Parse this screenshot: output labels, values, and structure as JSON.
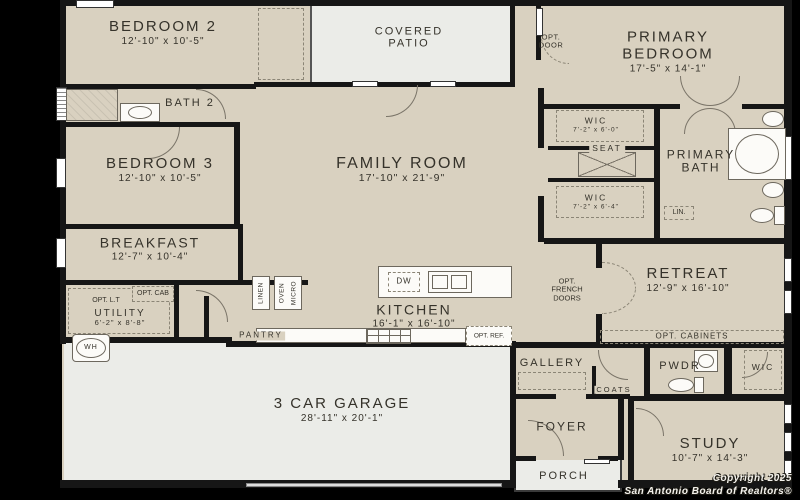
{
  "plan_title": "Single-story floor plan",
  "colors": {
    "background": "#000000",
    "room_fill": "#d9d1c0",
    "outdoor_fill": "#ebece8",
    "wall": "#161616",
    "text": "#35322a"
  },
  "rooms": {
    "bedroom2": {
      "name": "BEDROOM 2",
      "dims": "12'-10\" x 10'-5\""
    },
    "bath2": {
      "name": "BATH 2"
    },
    "bedroom3": {
      "name": "BEDROOM 3",
      "dims": "12'-10\" x 10'-5\""
    },
    "breakfast": {
      "name": "BREAKFAST",
      "dims": "12'-7\" x 10'-4\""
    },
    "utility": {
      "name": "UTILITY",
      "dims": "6'-2\" x 8'-8\""
    },
    "covered_patio": {
      "name": "COVERED PATIO"
    },
    "family_room": {
      "name": "FAMILY ROOM",
      "dims": "17'-10\" x 21'-9\""
    },
    "kitchen": {
      "name": "KITCHEN",
      "dims": "16'-1\" x 16'-10\""
    },
    "pantry": {
      "name": "PANTRY"
    },
    "primary_bedroom": {
      "name": "PRIMARY BEDROOM",
      "dims": "17'-5\" x 14'-1\""
    },
    "wic_top": {
      "name": "WIC",
      "dims": "7'-2\" x 6'-0\""
    },
    "wic_bottom": {
      "name": "WIC",
      "dims": "7'-2\" x 6'-4\""
    },
    "primary_bath": {
      "name": "PRIMARY BATH"
    },
    "retreat": {
      "name": "RETREAT",
      "dims": "12'-9\" x 16'-10\""
    },
    "garage": {
      "name": "3 CAR GARAGE",
      "dims": "28'-11\" x 20'-1\""
    },
    "gallery": {
      "name": "GALLERY"
    },
    "coats": {
      "name": "COATS"
    },
    "pwdr": {
      "name": "PWDR"
    },
    "wic_entry": {
      "name": "WIC"
    },
    "foyer": {
      "name": "FOYER"
    },
    "porch": {
      "name": "PORCH"
    },
    "study": {
      "name": "STUDY",
      "dims": "10'-7\" x 14'-3\""
    }
  },
  "annotations": {
    "opt_door": "OPT. DOOR",
    "opt_cab": "OPT. CAB",
    "opt_lt": "OPT. L.T",
    "wh": "WH",
    "seat": "SEAT",
    "lin": "LIN.",
    "linen": "LINEN",
    "oven": "OVEN",
    "micro": "MICRO",
    "dw": "DW",
    "opt_ref": "OPT. REF.",
    "opt_french_doors": "OPT. FRENCH DOORS",
    "opt_cabinets": "OPT. CABINETS"
  },
  "footer": {
    "line1": "Copyright 2025",
    "line2": "San Antonio Board of Realtors®"
  }
}
